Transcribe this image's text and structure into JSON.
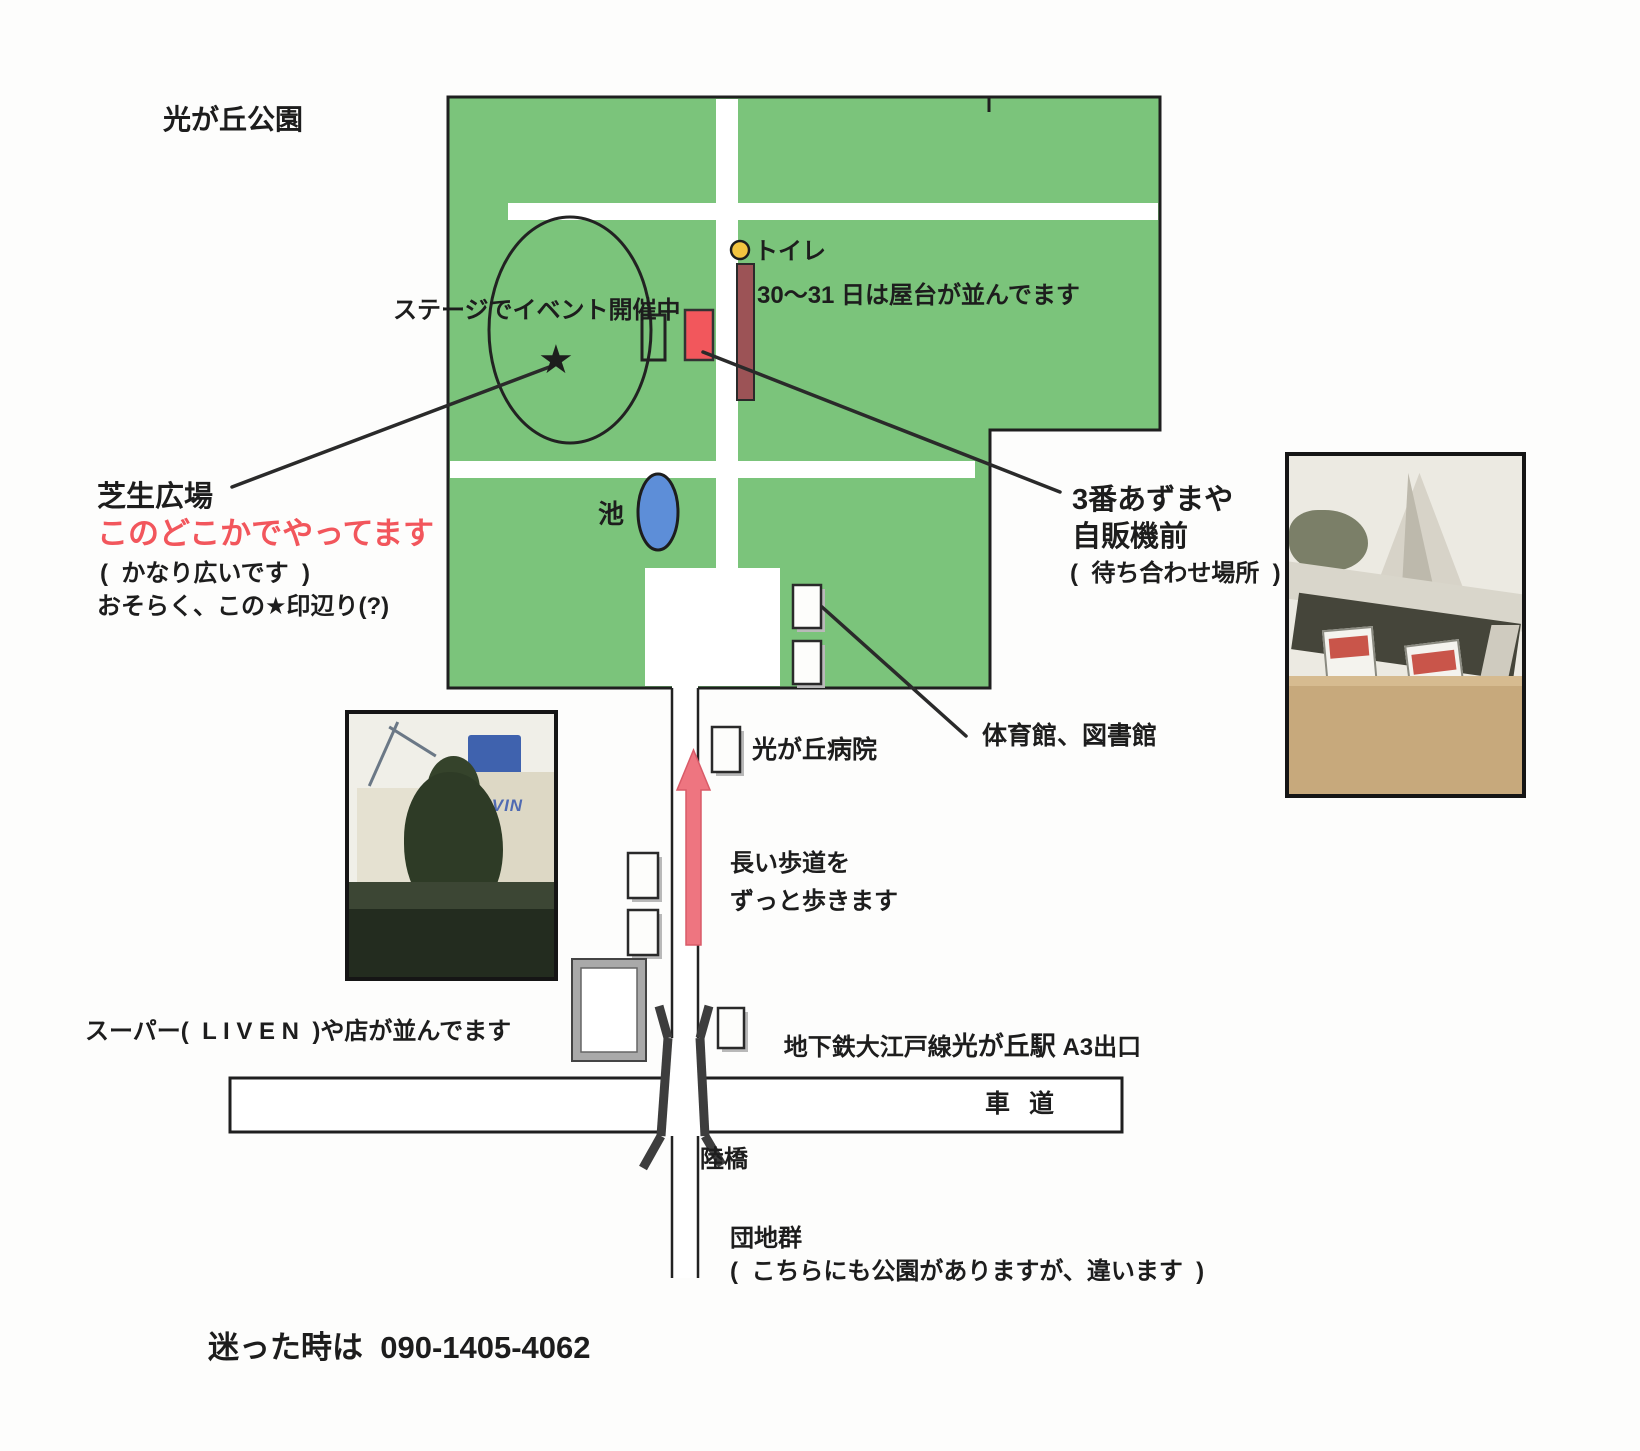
{
  "title": "光が丘公園",
  "park": {
    "stage_note": "ステージでイベント開催中",
    "star_glyph": "★",
    "toilet_label": "トイレ",
    "stalls_note": "30〜31 日は屋台が並んでます",
    "pond_label": "池"
  },
  "lawn": {
    "name": "芝生広場",
    "highlight": "このどこかでやってます",
    "note1": "(  かなり広いです  )",
    "note2": "おそらく、この★印辺り(?)"
  },
  "meeting_point": {
    "line1": "3番あずまや",
    "line2": "自販機前",
    "line3": "(  待ち合わせ場所  )"
  },
  "facilities": {
    "gym_library": "体育館、図書館",
    "hospital": "光が丘病院"
  },
  "route": {
    "walk_line1": "長い歩道を",
    "walk_line2": "ずっと歩きます",
    "shops_note": "スーパー(  L I V E N  )や店が並んでます",
    "station_prefix": "地下鉄大江戸線",
    "station_name": "光が丘駅",
    "station_exit": " A3出口",
    "road_label": "車 道",
    "overpass_label": "陸橋",
    "danchi_label": "団地群",
    "danchi_note": "(  こちらにも公園がありますが、違います  )"
  },
  "footer": {
    "contact": "迷った時は  090-1405-4062"
  },
  "photos": {
    "supermarket_sign": "LIVIN"
  },
  "colors": {
    "park_green": "#7bc47b",
    "path_white": "#ffffff",
    "pond_blue": "#5d8ed8",
    "stage_red": "#f2575c",
    "stall_brown": "#9c5356",
    "toilet_yellow": "#f3c440",
    "arrow_pink": "#ee7580",
    "highlight_red": "#f2565c",
    "outline_black": "#1f1f1f"
  }
}
